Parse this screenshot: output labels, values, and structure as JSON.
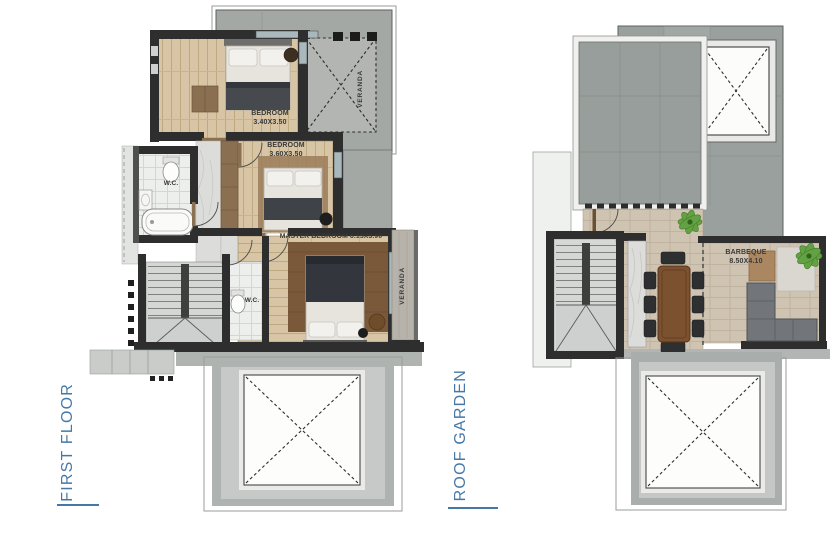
{
  "first_floor": {
    "title": "FIRST FLOOR",
    "labels": {
      "bedroom1_name": "BEDROOM",
      "bedroom1_dims": "3.40X3.50",
      "bedroom2_name": "BEDROOM",
      "bedroom2_dims": "3.60X3.50",
      "master": "MASTER BEDROOM 6.15X3.90",
      "wc_main": "W.C.",
      "wc_master": "W.C.",
      "veranda_top": "VERANDA",
      "veranda_side": "VERANDA"
    }
  },
  "roof_garden": {
    "title": "ROOF GARDEN",
    "labels": {
      "barbeque_name": "BARBEQUE",
      "barbeque_dims": "8.50X4.10"
    }
  },
  "colors": {
    "accent_blue": "#4678a7",
    "label_text": "#3a3a3a",
    "wall_dark": "#2e2e2e",
    "wood_floor": "#d8c5a5",
    "roof_gray": "#9aa09d",
    "terrace_paver": "#cfc3b2",
    "marble": "#dcdcda",
    "bath_tile": "#edefec",
    "plant_green": "#63a244",
    "table_wood": "#7c5130",
    "sofa_gray": "#72767a"
  }
}
